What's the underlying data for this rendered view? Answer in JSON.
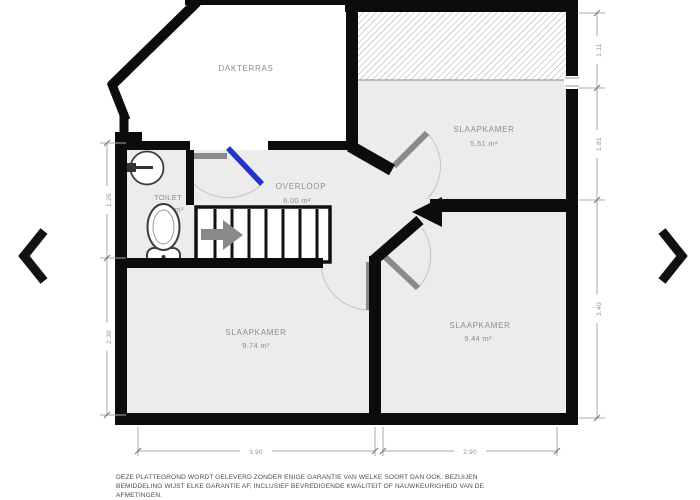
{
  "colors": {
    "wall": "#0c0c0c",
    "floor": "#ececec",
    "door": "#8a8a8a",
    "door_accent": "#2335c8",
    "label": "#8d8d8d"
  },
  "rooms": {
    "dakterras": {
      "name": "DAKTERRAS"
    },
    "slaapkamer1": {
      "name": "SLAAPKAMER",
      "area": "5.51 m²"
    },
    "toilet": {
      "name": "TOILET",
      "area": "1.37 m²"
    },
    "overloop": {
      "name": "OVERLOOP",
      "area": "6.00 m²"
    },
    "slaapkamer2": {
      "name": "SLAAPKAMER",
      "area": "9.74 m²"
    },
    "slaapkamer3": {
      "name": "SLAAPKAMER",
      "area": "9.44 m²"
    }
  },
  "dimensions": {
    "bottom_left": "3.90",
    "bottom_right": "2.90",
    "right_top": "1.11",
    "right_mid": "1.81",
    "right_bottom": "3.40",
    "left_top": "1.26",
    "left_bottom": "2.30"
  },
  "disclaimer": {
    "line1": "DEZE PLATTEGROND WORDT GELEVERD ZONDER ENIGE GARANTIE VAN WELKE SOORT DAN OOK. BEZUIJEN",
    "line2": "BEMIDDELING WIJST ELKE GARANTIE AF, INCLUSIEF BEVREDIGENDE KWALITEIT OF NAUWKEURIGHEID VAN DE",
    "line3": "AFMETINGEN."
  },
  "carousel": {
    "prev_icon": "chevron-left",
    "next_icon": "chevron-right"
  }
}
